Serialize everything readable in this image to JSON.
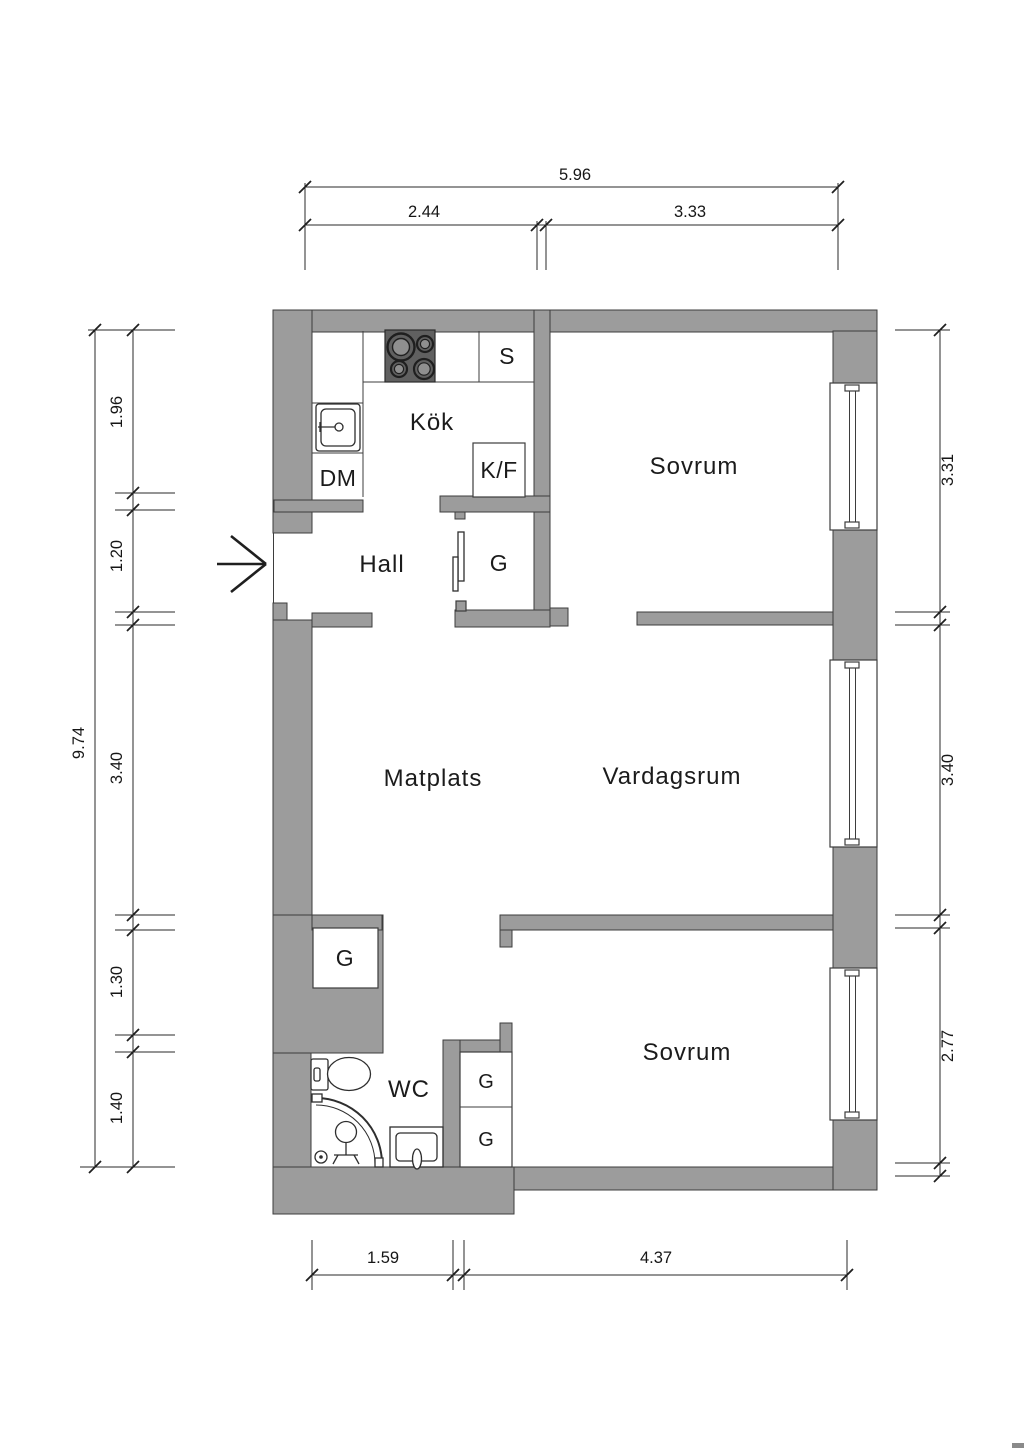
{
  "labels": {
    "kitchen": "Kök",
    "hall": "Hall",
    "dining": "Matplats",
    "living": "Vardagsrum",
    "bedroom_top": "Sovrum",
    "bedroom_bottom": "Sovrum",
    "wc": "WC",
    "pantry": "S",
    "dishwasher": "DM",
    "fridge_freezer": "K/F",
    "closet_hall": "G",
    "closet_lower": "G",
    "closet_bedroom_upper": "G",
    "closet_bedroom_lower": "G"
  },
  "dims": {
    "top_total": "5.96",
    "top_a": "2.44",
    "top_b": "3.33",
    "left_total": "9.74",
    "left_a": "1.96",
    "left_b": "1.20",
    "left_c": "3.40",
    "left_d": "1.30",
    "left_e": "1.40",
    "right_a": "3.31",
    "right_b": "3.40",
    "right_c": "2.77",
    "bottom_a": "1.59",
    "bottom_b": "4.37"
  },
  "colors": {
    "wall": "#9c9c9c",
    "wall_outline": "#3d3d3d",
    "stove": "#606060",
    "text": "#1b1b1b"
  }
}
